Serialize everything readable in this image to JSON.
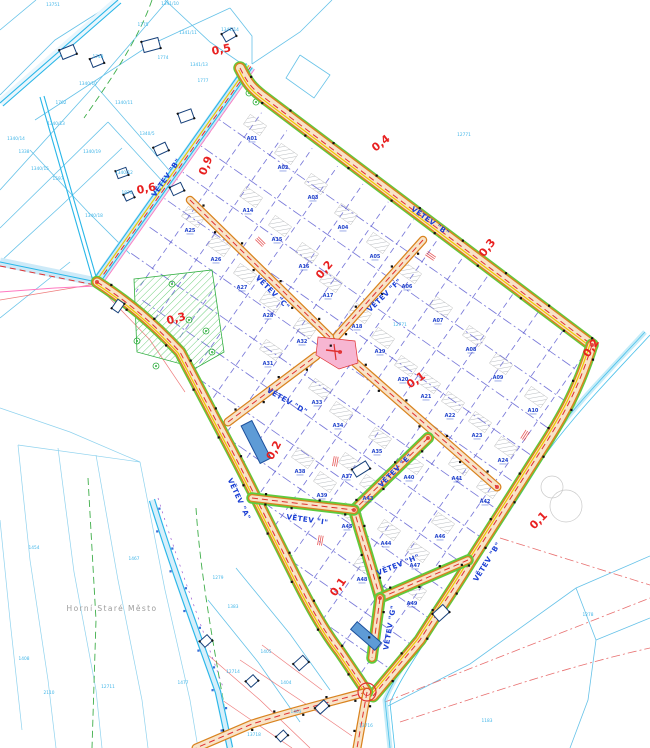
{
  "map": {
    "type": "cadastral-subdivision-plan",
    "place_label": {
      "text": "Horní Staré Město",
      "x": 112,
      "y": 611
    },
    "street_labels": [
      {
        "label": "VĚTEV \"B\"",
        "x": 168,
        "y": 179,
        "rot": -55
      },
      {
        "label": "VĚTEV \"B\"",
        "x": 429,
        "y": 223,
        "rot": 35
      },
      {
        "label": "VĚTEV \"B\"",
        "x": 489,
        "y": 563,
        "rot": -58
      },
      {
        "label": "VĚTEV \"C\"",
        "x": 271,
        "y": 294,
        "rot": 45
      },
      {
        "label": "VĚTEV \"F\"",
        "x": 386,
        "y": 297,
        "rot": -44
      },
      {
        "label": "VĚTEV \"D\"",
        "x": 286,
        "y": 403,
        "rot": 30
      },
      {
        "label": "VĚTEV \"A\"",
        "x": 237,
        "y": 500,
        "rot": 65
      },
      {
        "label": "VĚTEV \"I\"",
        "x": 307,
        "y": 522,
        "rot": 8
      },
      {
        "label": "VĚTEV \"E\"",
        "x": 397,
        "y": 472,
        "rot": -45
      },
      {
        "label": "VĚTEV \"H\"",
        "x": 399,
        "y": 567,
        "rot": -22
      },
      {
        "label": "VĚTEV \"G\"",
        "x": 392,
        "y": 628,
        "rot": -80
      }
    ],
    "chainage_markers": [
      {
        "value": "0,5",
        "x": 222,
        "y": 53,
        "rot": -12
      },
      {
        "value": "0,9",
        "x": 209,
        "y": 167,
        "rot": -68
      },
      {
        "value": "0,6",
        "x": 147,
        "y": 192,
        "rot": -12
      },
      {
        "value": "0,4",
        "x": 383,
        "y": 146,
        "rot": -38
      },
      {
        "value": "0,3",
        "x": 490,
        "y": 250,
        "rot": -52
      },
      {
        "value": "0,2",
        "x": 327,
        "y": 272,
        "rot": -50
      },
      {
        "value": "0,3",
        "x": 177,
        "y": 322,
        "rot": -15
      },
      {
        "value": "0,1",
        "x": 418,
        "y": 383,
        "rot": -35
      },
      {
        "value": "0,2",
        "x": 594,
        "y": 350,
        "rot": -55
      },
      {
        "value": "0,2",
        "x": 277,
        "y": 452,
        "rot": -62
      },
      {
        "value": "0,1",
        "x": 541,
        "y": 523,
        "rot": -45
      },
      {
        "value": "0,1",
        "x": 341,
        "y": 589,
        "rot": -55
      }
    ],
    "plots": [
      {
        "id": "A01",
        "x": 252,
        "y": 140
      },
      {
        "id": "A02",
        "x": 283,
        "y": 169
      },
      {
        "id": "A03",
        "x": 313,
        "y": 199
      },
      {
        "id": "A04",
        "x": 343,
        "y": 229
      },
      {
        "id": "A05",
        "x": 375,
        "y": 258
      },
      {
        "id": "A06",
        "x": 407,
        "y": 288
      },
      {
        "id": "A07",
        "x": 438,
        "y": 322
      },
      {
        "id": "A08",
        "x": 471,
        "y": 351
      },
      {
        "id": "A09",
        "x": 498,
        "y": 379
      },
      {
        "id": "A10",
        "x": 533,
        "y": 412
      },
      {
        "id": "A14",
        "x": 248,
        "y": 212
      },
      {
        "id": "A15",
        "x": 277,
        "y": 241
      },
      {
        "id": "A16",
        "x": 304,
        "y": 268
      },
      {
        "id": "A17",
        "x": 328,
        "y": 297
      },
      {
        "id": "A18",
        "x": 357,
        "y": 328
      },
      {
        "id": "A19",
        "x": 380,
        "y": 353
      },
      {
        "id": "A20",
        "x": 403,
        "y": 381
      },
      {
        "id": "A21",
        "x": 426,
        "y": 398
      },
      {
        "id": "A22",
        "x": 450,
        "y": 417
      },
      {
        "id": "A23",
        "x": 477,
        "y": 437
      },
      {
        "id": "A24",
        "x": 503,
        "y": 462
      },
      {
        "id": "A25",
        "x": 190,
        "y": 232
      },
      {
        "id": "A26",
        "x": 216,
        "y": 261
      },
      {
        "id": "A27",
        "x": 242,
        "y": 289
      },
      {
        "id": "A28",
        "x": 268,
        "y": 317
      },
      {
        "id": "A31",
        "x": 268,
        "y": 365
      },
      {
        "id": "A32",
        "x": 302,
        "y": 343
      },
      {
        "id": "A33",
        "x": 317,
        "y": 404
      },
      {
        "id": "A34",
        "x": 338,
        "y": 427
      },
      {
        "id": "A35",
        "x": 377,
        "y": 453
      },
      {
        "id": "A37",
        "x": 347,
        "y": 478
      },
      {
        "id": "A38",
        "x": 300,
        "y": 473
      },
      {
        "id": "A39",
        "x": 322,
        "y": 497
      },
      {
        "id": "A40",
        "x": 409,
        "y": 479
      },
      {
        "id": "A41",
        "x": 457,
        "y": 480
      },
      {
        "id": "A42",
        "x": 485,
        "y": 503
      },
      {
        "id": "A43",
        "x": 368,
        "y": 500
      },
      {
        "id": "A44",
        "x": 386,
        "y": 545
      },
      {
        "id": "A45",
        "x": 347,
        "y": 528
      },
      {
        "id": "A46",
        "x": 440,
        "y": 538
      },
      {
        "id": "A47",
        "x": 415,
        "y": 567
      },
      {
        "id": "A48",
        "x": 362,
        "y": 581
      },
      {
        "id": "A49",
        "x": 412,
        "y": 605
      }
    ],
    "background_parcels": [
      {
        "id": "13751",
        "x": 53,
        "y": 6
      },
      {
        "id": "1341/10",
        "x": 170,
        "y": 5
      },
      {
        "id": "1341/11",
        "x": 188,
        "y": 34
      },
      {
        "id": "1341/14",
        "x": 230,
        "y": 31
      },
      {
        "id": "1775",
        "x": 143,
        "y": 26
      },
      {
        "id": "1774",
        "x": 163,
        "y": 59
      },
      {
        "id": "1341/13",
        "x": 199,
        "y": 66
      },
      {
        "id": "1777",
        "x": 203,
        "y": 82
      },
      {
        "id": "1748",
        "x": 98,
        "y": 58
      },
      {
        "id": "1762",
        "x": 61,
        "y": 104
      },
      {
        "id": "1340/10",
        "x": 88,
        "y": 85
      },
      {
        "id": "1340/11",
        "x": 124,
        "y": 104
      },
      {
        "id": "1340/13",
        "x": 56,
        "y": 125
      },
      {
        "id": "1340/14",
        "x": 16,
        "y": 140
      },
      {
        "id": "1340/5",
        "x": 147,
        "y": 135
      },
      {
        "id": "1340/19",
        "x": 92,
        "y": 153
      },
      {
        "id": "1340/15",
        "x": 40,
        "y": 170
      },
      {
        "id": "1338",
        "x": 24,
        "y": 153
      },
      {
        "id": "1597",
        "x": 58,
        "y": 180
      },
      {
        "id": "1340/12",
        "x": 124,
        "y": 174
      },
      {
        "id": "1870",
        "x": 127,
        "y": 194
      },
      {
        "id": "1340/18",
        "x": 94,
        "y": 217
      },
      {
        "id": "12771",
        "x": 464,
        "y": 136
      },
      {
        "id": "12771",
        "x": 400,
        "y": 326
      },
      {
        "id": "1454",
        "x": 34,
        "y": 549
      },
      {
        "id": "1467",
        "x": 134,
        "y": 560
      },
      {
        "id": "1279",
        "x": 218,
        "y": 579
      },
      {
        "id": "1383",
        "x": 233,
        "y": 608
      },
      {
        "id": "1408",
        "x": 24,
        "y": 660
      },
      {
        "id": "12711",
        "x": 108,
        "y": 688
      },
      {
        "id": "2110",
        "x": 49,
        "y": 694
      },
      {
        "id": "1477",
        "x": 183,
        "y": 684
      },
      {
        "id": "12714",
        "x": 233,
        "y": 673
      },
      {
        "id": "1405",
        "x": 266,
        "y": 653
      },
      {
        "id": "1404",
        "x": 286,
        "y": 684
      },
      {
        "id": "1403",
        "x": 296,
        "y": 713
      },
      {
        "id": "13718",
        "x": 254,
        "y": 736
      },
      {
        "id": "13716",
        "x": 366,
        "y": 727
      },
      {
        "id": "1183",
        "x": 487,
        "y": 722
      },
      {
        "id": "1278",
        "x": 588,
        "y": 616
      }
    ],
    "colors": {
      "road_casing": "#d9831f",
      "road_fill": "#f8e3c8",
      "centerline_red": "#e03030",
      "verge_green": "#5ecb3e",
      "plot_blue": "#2244cc",
      "parcel_cyan": "#3fb5e8",
      "street_blue": "#1b3fd4",
      "chainage_red": "#e82020",
      "cadastral_cyan": "#66c2e8",
      "green_area": "#2fae3f",
      "basin_blue": "#5e9bd6",
      "pink_junction": "#f7b6d2"
    }
  }
}
